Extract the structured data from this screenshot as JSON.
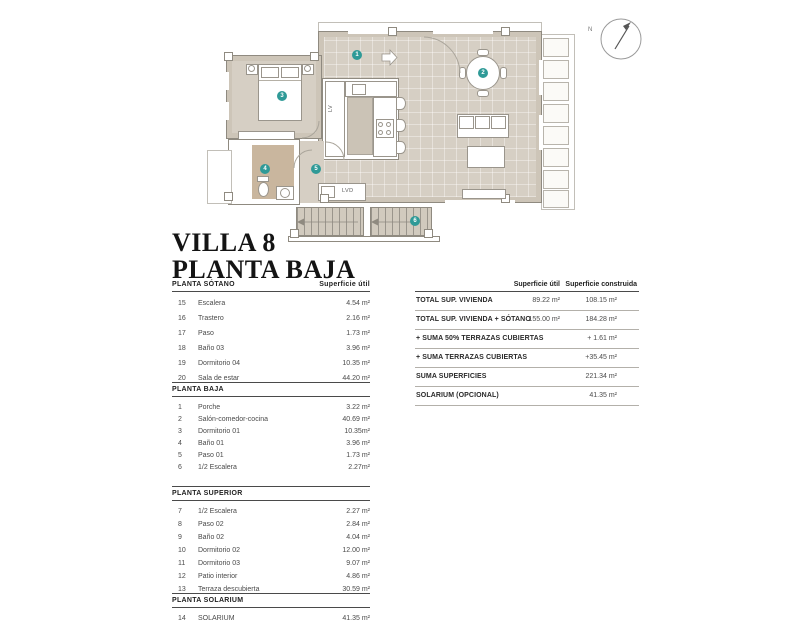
{
  "title": {
    "line1": "VILLA 8",
    "line2": "PLANTA BAJA"
  },
  "plan": {
    "markers": [
      "1",
      "2",
      "3",
      "4",
      "5",
      "6"
    ],
    "labels": {
      "lv": "LV",
      "lvd": "LVD",
      "north": "N"
    },
    "colors": {
      "wall": "#cdc5b8",
      "floor": "#d6cfc4",
      "bath_floor": "#c9b69e",
      "marker_teal": "#2f9a97",
      "outline": "#8f8a80"
    }
  },
  "tables": {
    "left_sections": [
      {
        "title": "PLANTA SÓTANO",
        "col_header": "Superficie útil",
        "rows": [
          {
            "num": "15",
            "label": "Escalera",
            "value": "4.54 m²"
          },
          {
            "num": "16",
            "label": "Trastero",
            "value": "2.16 m²"
          },
          {
            "num": "17",
            "label": "Paso",
            "value": "1.73 m²"
          },
          {
            "num": "18",
            "label": "Baño 03",
            "value": "3.96 m²"
          },
          {
            "num": "19",
            "label": "Dormitorio 04",
            "value": "10.35 m²"
          },
          {
            "num": "20",
            "label": "Sala de estar",
            "value": "44.20 m²"
          }
        ]
      },
      {
        "title": "PLANTA BAJA",
        "rows": [
          {
            "num": "1",
            "label": "Porche",
            "value": "3.22 m²"
          },
          {
            "num": "2",
            "label": "Salón-comedor-cocina",
            "value": "40.69 m²"
          },
          {
            "num": "3",
            "label": "Dormitorio 01",
            "value": "10.35m²"
          },
          {
            "num": "4",
            "label": "Baño 01",
            "value": "3.96 m²"
          },
          {
            "num": "5",
            "label": "Paso 01",
            "value": "1.73 m²"
          },
          {
            "num": "6",
            "label": "1/2 Escalera",
            "value": "2.27m²"
          }
        ]
      },
      {
        "title": "PLANTA SUPERIOR",
        "rows": [
          {
            "num": "7",
            "label": "1/2 Escalera",
            "value": "2.27 m²"
          },
          {
            "num": "8",
            "label": "Paso 02",
            "value": "2.84 m²"
          },
          {
            "num": "9",
            "label": "Baño 02",
            "value": "4.04 m²"
          },
          {
            "num": "10",
            "label": "Dormitorio 02",
            "value": "12.00 m²"
          },
          {
            "num": "11",
            "label": "Dormitorio 03",
            "value": "9.07 m²"
          },
          {
            "num": "12",
            "label": "Patio interior",
            "value": "4.86 m²"
          },
          {
            "num": "13",
            "label": "Terraza descubierta",
            "value": "30.59 m²"
          }
        ]
      },
      {
        "title": "PLANTA SOLARIUM",
        "rows": [
          {
            "num": "14",
            "label": "SOLARIUM",
            "value": "41.35 m²"
          }
        ]
      }
    ],
    "summary": {
      "col1_header": "Superficie útil",
      "col2_header": "Superficie construida",
      "rows": [
        {
          "label": "TOTAL SUP. VIVIENDA",
          "util": "89.22 m²",
          "construida": "108.15 m²"
        },
        {
          "label": "TOTAL SUP. VIVIENDA + SÓTANO",
          "util": "155.00 m²",
          "construida": "184.28 m²"
        },
        {
          "label": "+ SUMA 50% TERRAZAS CUBIERTAS",
          "util": "",
          "construida": "+ 1.61 m²"
        },
        {
          "label": "+ SUMA TERRAZAS CUBIERTAS",
          "util": "",
          "construida": "+35.45 m²"
        },
        {
          "label": "SUMA SUPERFICIES",
          "util": "",
          "construida": "221.34 m²"
        },
        {
          "label": "SOLARIUM (OPCIONAL)",
          "util": "",
          "construida": "41.35 m²"
        }
      ]
    }
  }
}
